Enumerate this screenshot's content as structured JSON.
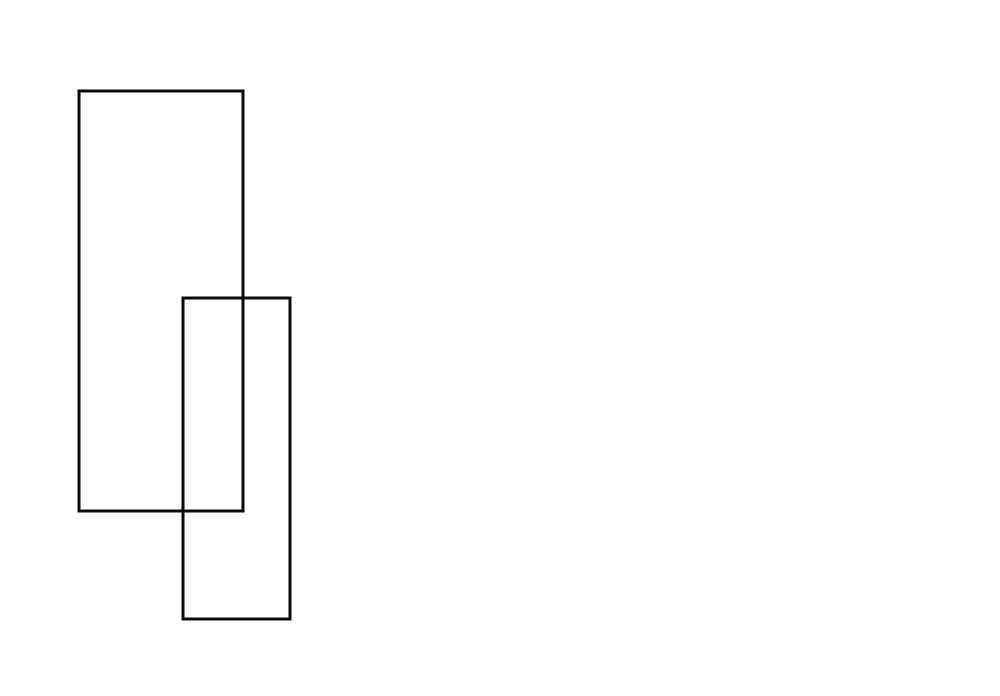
{
  "canvas": {
    "width": 1000,
    "height": 696,
    "background_color": "#ffffff"
  },
  "shapes": {
    "rect_large": {
      "x": 79,
      "y": 91,
      "width": 164,
      "height": 420,
      "fill": "none",
      "stroke": "#0a0a0a",
      "stroke_width": 3
    },
    "rect_small": {
      "x": 183,
      "y": 298,
      "width": 107,
      "height": 321,
      "fill": "none",
      "stroke": "#0a0a0a",
      "stroke_width": 3
    }
  }
}
